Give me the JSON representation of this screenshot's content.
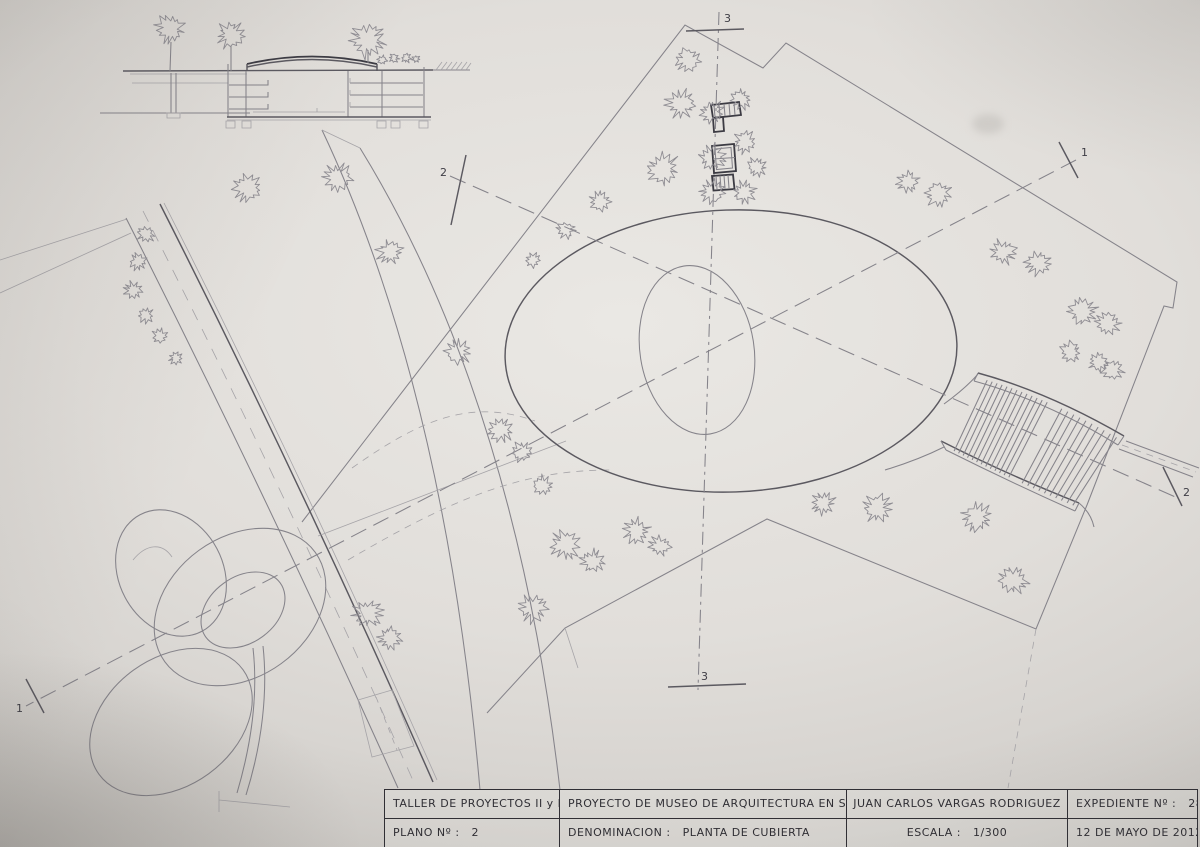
{
  "title_block": {
    "taller": "TALLER DE PROYECTOS  II y III",
    "proyecto": "PROYECTO DE MUSEO DE ARQUITECTURA EN SEVILLA",
    "autor": "JUAN CARLOS VARGAS RODRIGUEZ",
    "expediente_label": "EXPEDIENTE Nº :",
    "expediente_value": "28.721",
    "plano_label": "PLANO Nº :",
    "plano_value": "2",
    "denominacion_label": "DENOMINACION :",
    "denominacion_value": "PLANTA DE CUBIERTA",
    "escala_label": "ESCALA :",
    "escala_value": "1/300",
    "fecha": "12 DE MAYO DE 2012"
  },
  "section_markers": {
    "one": "1",
    "two": "2",
    "three": "3"
  },
  "colors": {
    "paper": "#e1deda",
    "paper_edge": "#c5c2be",
    "pencil_faint": "#a6a4a8",
    "pencil": "#85838a",
    "pencil_dark": "#3c3b43",
    "ink": "#2f2e34"
  },
  "plan": {
    "pergola": {
      "slats_left": 13,
      "slats_right": 10
    },
    "trees": [
      {
        "x": 688,
        "y": 60,
        "r": 13
      },
      {
        "x": 681,
        "y": 104,
        "r": 15
      },
      {
        "x": 712,
        "y": 112,
        "r": 12
      },
      {
        "x": 741,
        "y": 99,
        "r": 11
      },
      {
        "x": 663,
        "y": 169,
        "r": 17
      },
      {
        "x": 712,
        "y": 158,
        "r": 13
      },
      {
        "x": 745,
        "y": 142,
        "r": 12
      },
      {
        "x": 757,
        "y": 167,
        "r": 10
      },
      {
        "x": 712,
        "y": 192,
        "r": 13
      },
      {
        "x": 744,
        "y": 192,
        "r": 12
      },
      {
        "x": 600,
        "y": 201,
        "r": 11
      },
      {
        "x": 566,
        "y": 230,
        "r": 9
      },
      {
        "x": 533,
        "y": 260,
        "r": 8
      },
      {
        "x": 908,
        "y": 182,
        "r": 11
      },
      {
        "x": 938,
        "y": 194,
        "r": 13
      },
      {
        "x": 1003,
        "y": 252,
        "r": 13
      },
      {
        "x": 1038,
        "y": 263,
        "r": 13
      },
      {
        "x": 1083,
        "y": 311,
        "r": 14
      },
      {
        "x": 1108,
        "y": 323,
        "r": 12
      },
      {
        "x": 1071,
        "y": 352,
        "r": 11
      },
      {
        "x": 1113,
        "y": 370,
        "r": 11
      },
      {
        "x": 1098,
        "y": 362,
        "r": 10
      },
      {
        "x": 823,
        "y": 503,
        "r": 12
      },
      {
        "x": 877,
        "y": 508,
        "r": 14
      },
      {
        "x": 977,
        "y": 517,
        "r": 15
      },
      {
        "x": 1013,
        "y": 580,
        "r": 15
      },
      {
        "x": 543,
        "y": 486,
        "r": 11
      },
      {
        "x": 565,
        "y": 545,
        "r": 15
      },
      {
        "x": 592,
        "y": 561,
        "r": 12
      },
      {
        "x": 637,
        "y": 531,
        "r": 13
      },
      {
        "x": 660,
        "y": 546,
        "r": 11
      },
      {
        "x": 533,
        "y": 608,
        "r": 15
      },
      {
        "x": 248,
        "y": 188,
        "r": 14
      },
      {
        "x": 338,
        "y": 177,
        "r": 14
      },
      {
        "x": 390,
        "y": 252,
        "r": 13
      },
      {
        "x": 458,
        "y": 352,
        "r": 13
      },
      {
        "x": 500,
        "y": 430,
        "r": 13
      },
      {
        "x": 522,
        "y": 452,
        "r": 11
      },
      {
        "x": 368,
        "y": 614,
        "r": 15
      },
      {
        "x": 390,
        "y": 638,
        "r": 12
      },
      {
        "x": 146,
        "y": 234,
        "r": 9
      },
      {
        "x": 138,
        "y": 262,
        "r": 9
      },
      {
        "x": 133,
        "y": 290,
        "r": 9
      },
      {
        "x": 146,
        "y": 315,
        "r": 8
      },
      {
        "x": 160,
        "y": 336,
        "r": 8
      },
      {
        "x": 176,
        "y": 358,
        "r": 7
      }
    ],
    "elevation_trees": [
      {
        "x": 170,
        "y": 29,
        "r": 15
      },
      {
        "x": 231,
        "y": 35,
        "r": 14
      },
      {
        "x": 368,
        "y": 40,
        "r": 18
      }
    ],
    "bushes": [
      {
        "x": 382,
        "y": 60,
        "r": 5
      },
      {
        "x": 394,
        "y": 58,
        "r": 5
      },
      {
        "x": 406,
        "y": 58,
        "r": 5
      },
      {
        "x": 416,
        "y": 59,
        "r": 4
      }
    ]
  }
}
